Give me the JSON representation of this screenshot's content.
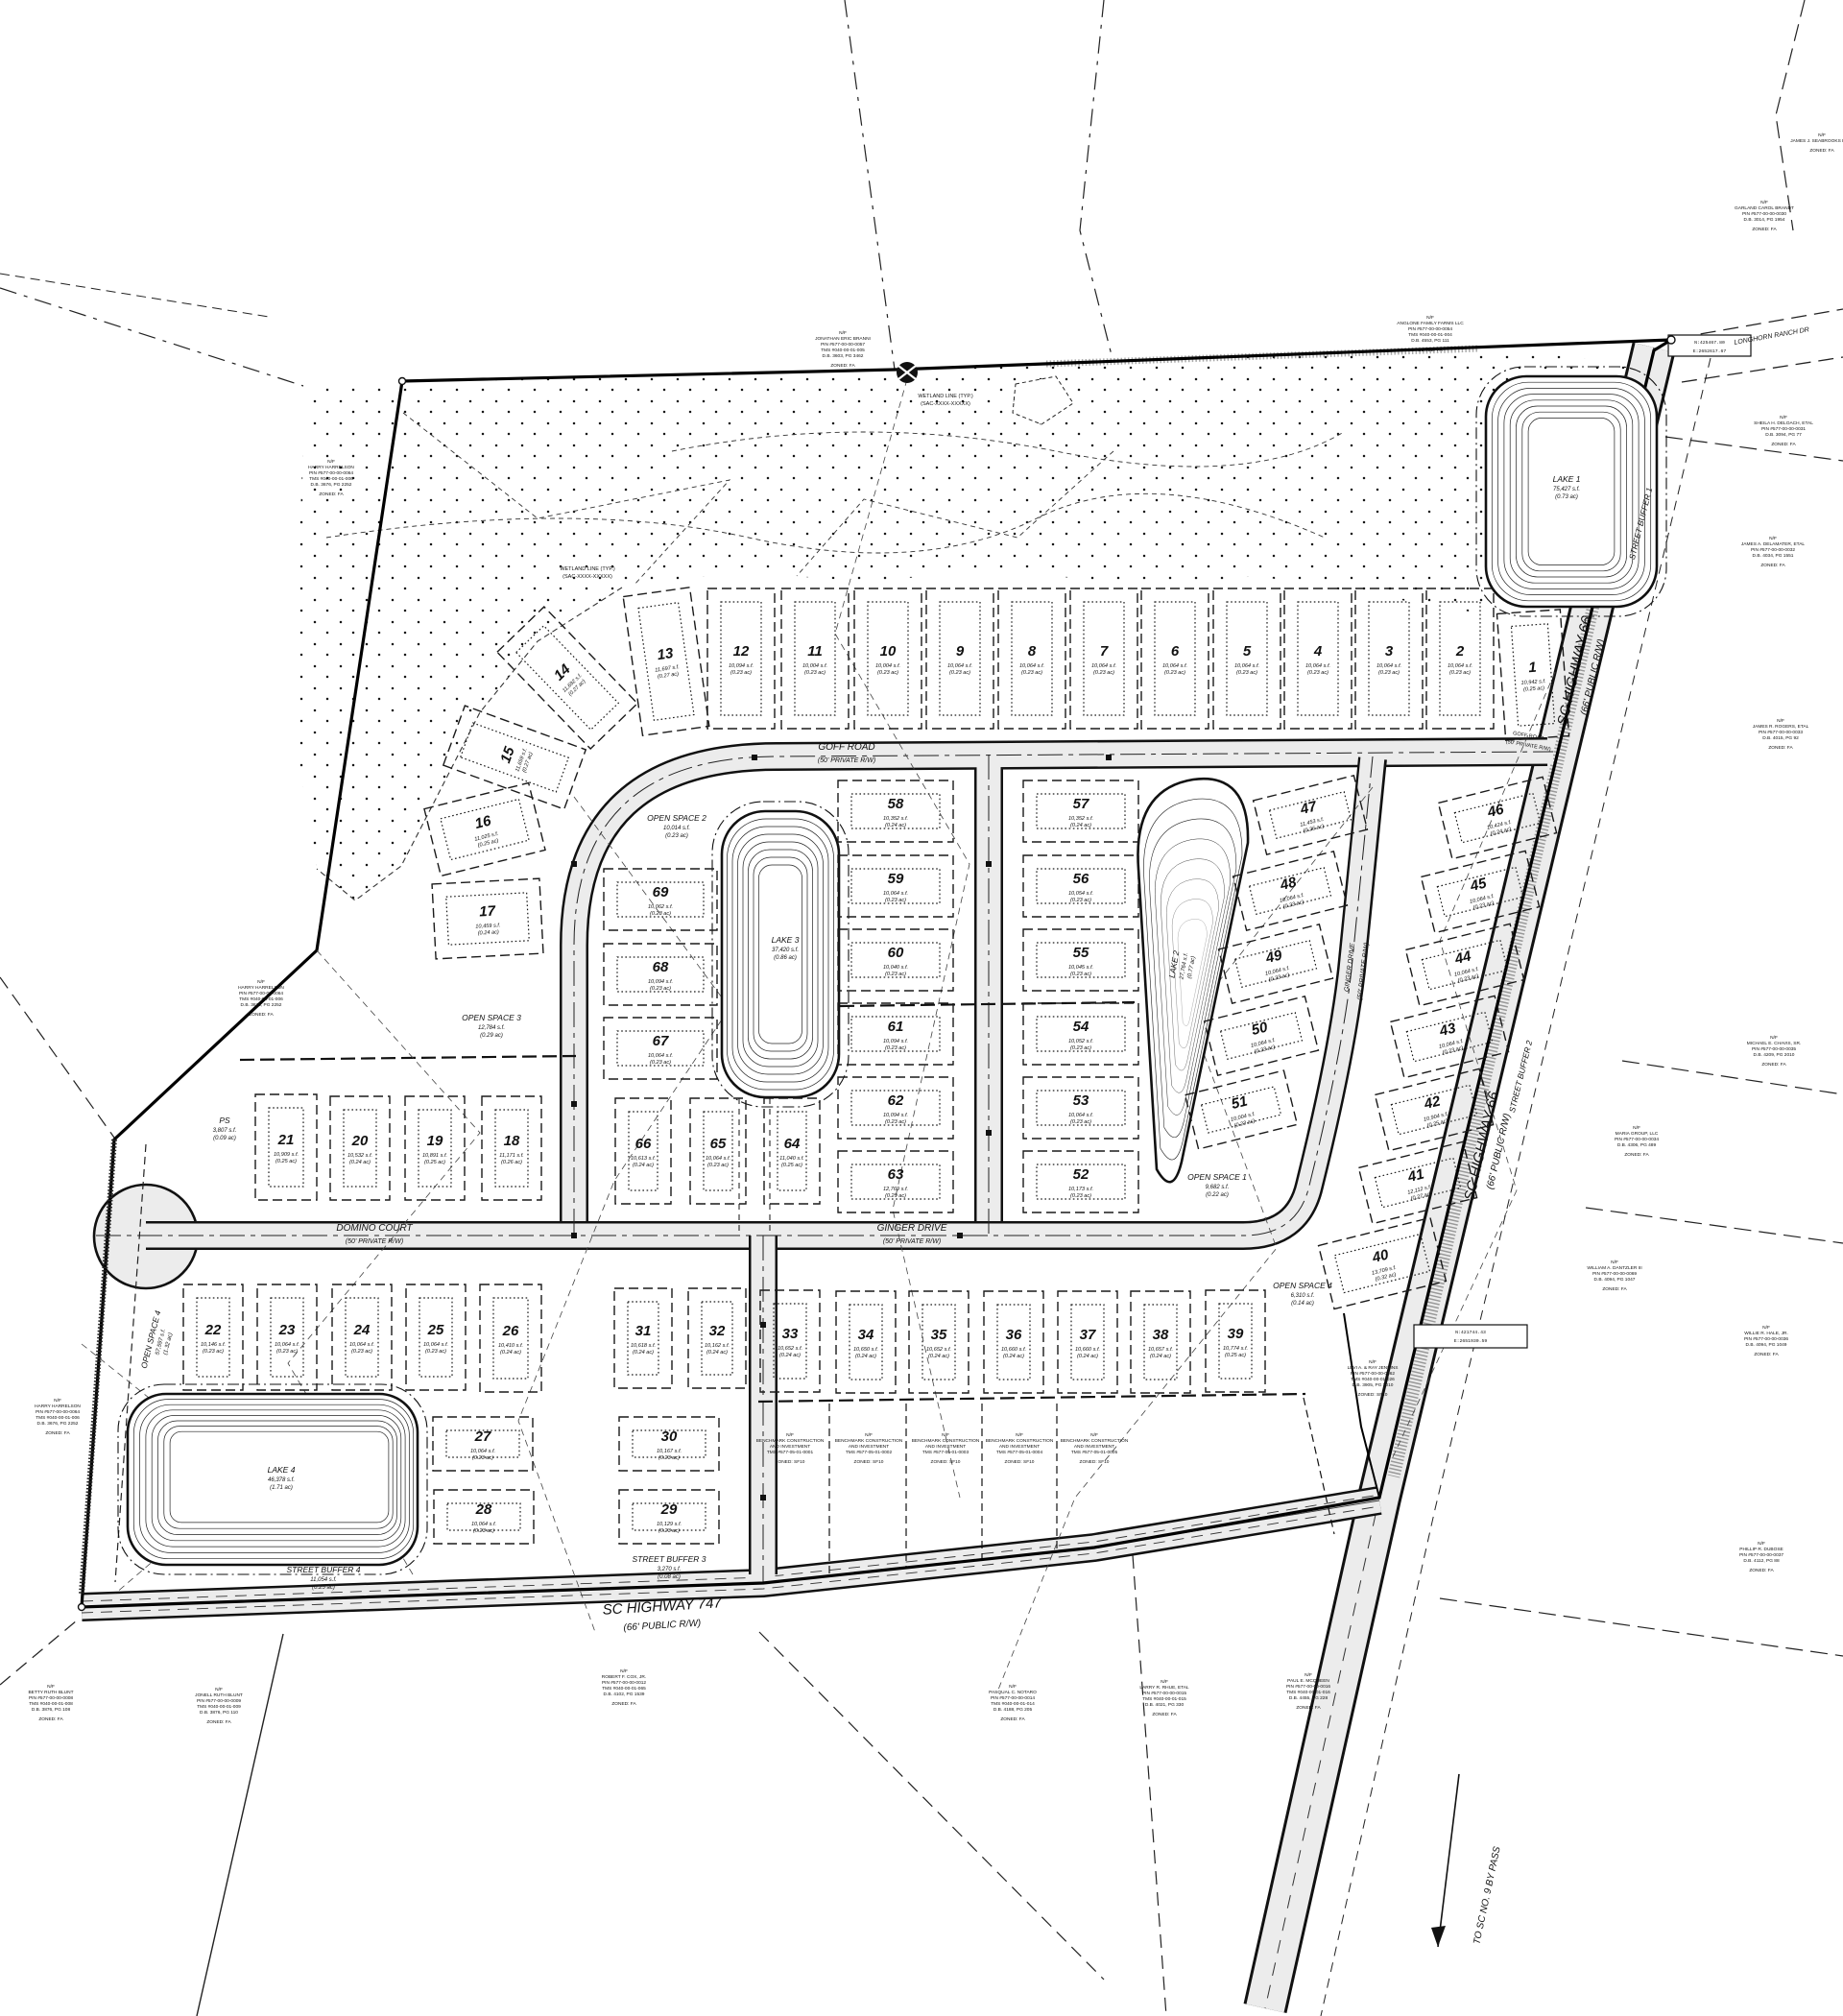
{
  "roads": {
    "goff": {
      "name": "GOFF ROAD",
      "rw": "(50' PRIVATE R/W)"
    },
    "goff_east": {
      "name": "GOFF ROAD",
      "rw": "(50' PRIVATE R/W)"
    },
    "domino": {
      "name": "DOMINO COURT",
      "rw": "(50' PRIVATE R/W)"
    },
    "ginger": {
      "name": "GINGER DRIVE",
      "rw": "(50' PRIVATE R/W)"
    },
    "ginger_diag": {
      "name": "GINGER DRIVE",
      "rw": "(50' PRIVATE R/W)"
    },
    "hwy747": {
      "name": "SC HIGHWAY 747",
      "rw": "(66' PUBLIC R/W)"
    },
    "hwy66_upper": {
      "name": "SC HIGHWAY 66",
      "rw": "(66' PUBLIC R/W)"
    },
    "hwy66_lower": {
      "name": "SC HIGHWAY 66",
      "rw": "(66' PUBLIC R/W)"
    },
    "longhorn": {
      "name": "LONGHORN RANCH DR"
    },
    "to_sc9": {
      "name": "TO SC NO. 9 BY PASS"
    }
  },
  "wetland": {
    "label": "WETLAND LINE (TYP.)",
    "sub": "(SAC-XXXX-XXXXX)"
  },
  "lakes": [
    {
      "name": "LAKE 1",
      "area": "75,427 s.f.",
      "acres": "(0.73 ac)"
    },
    {
      "name": "LAKE 2",
      "area": "27,764 s.f.",
      "acres": "(0.77 ac)"
    },
    {
      "name": "LAKE 3",
      "area": "37,420 s.f.",
      "acres": "(0.86 ac)"
    },
    {
      "name": "LAKE 4",
      "area": "46,378 s.f.",
      "acres": "(1.71 ac)"
    }
  ],
  "open_spaces": [
    {
      "name": "OPEN SPACE 1",
      "area": "9,682 s.f.",
      "acres": "(0.22 ac)"
    },
    {
      "name": "OPEN SPACE 2",
      "area": "10,014 s.f.",
      "acres": "(0.23 ac)"
    },
    {
      "name": "OPEN SPACE 3",
      "area": "12,784 s.f.",
      "acres": "(0.29 ac)"
    },
    {
      "name": "OPEN SPACE 4",
      "area": "6,310 s.f.",
      "acres": "(0.14 ac)"
    },
    {
      "name": "OPEN SPACE 4",
      "area": "57,597 s.f.",
      "acres": "(1.32 ac)"
    }
  ],
  "street_buffers": [
    {
      "name": "STREET BUFFER 1",
      "area": "",
      "acres": ""
    },
    {
      "name": "STREET BUFFER 2",
      "area": "",
      "acres": ""
    },
    {
      "name": "STREET BUFFER 3",
      "area": "3,270 s.f.",
      "acres": "(0.08 ac)"
    },
    {
      "name": "STREET BUFFER 4",
      "area": "11,054 s.f.",
      "acres": "(0.25 ac)"
    }
  ],
  "pump_station": {
    "name": "PS",
    "area": "3,807 s.f.",
    "acres": "(0.09 ac)"
  },
  "coord_boxes": [
    {
      "lines": [
        "N:421744.43",
        "E:2651930.59"
      ]
    },
    {
      "lines": [
        "N:425467.80",
        "E:2652617.67"
      ]
    }
  ],
  "lots": [
    {
      "num": "1",
      "area": "10,942 s.f.",
      "acres": "(0.25 ac)"
    },
    {
      "num": "2",
      "area": "10,064 s.f.",
      "acres": "(0.23 ac)"
    },
    {
      "num": "3",
      "area": "10,064 s.f.",
      "acres": "(0.23 ac)"
    },
    {
      "num": "4",
      "area": "10,064 s.f.",
      "acres": "(0.23 ac)"
    },
    {
      "num": "5",
      "area": "10,064 s.f.",
      "acres": "(0.23 ac)"
    },
    {
      "num": "6",
      "area": "10,064 s.f.",
      "acres": "(0.23 ac)"
    },
    {
      "num": "7",
      "area": "10,064 s.f.",
      "acres": "(0.23 ac)"
    },
    {
      "num": "8",
      "area": "10,064 s.f.",
      "acres": "(0.23 ac)"
    },
    {
      "num": "9",
      "area": "10,064 s.f.",
      "acres": "(0.23 ac)"
    },
    {
      "num": "10",
      "area": "10,004 s.f.",
      "acres": "(0.23 ac)"
    },
    {
      "num": "11",
      "area": "10,004 s.f.",
      "acres": "(0.23 ac)"
    },
    {
      "num": "12",
      "area": "10,094 s.f.",
      "acres": "(0.23 ac)"
    },
    {
      "num": "13",
      "area": "11,697 s.f.",
      "acres": "(0.27 ac)"
    },
    {
      "num": "14",
      "area": "11,692 s.f.",
      "acres": "(0.27 ac)"
    },
    {
      "num": "15",
      "area": "11,659 s.f.",
      "acres": "(0.27 ac)"
    },
    {
      "num": "16",
      "area": "11,025 s.f.",
      "acres": "(0.25 ac)"
    },
    {
      "num": "17",
      "area": "10,459 s.f.",
      "acres": "(0.24 ac)"
    },
    {
      "num": "18",
      "area": "11,171 s.f.",
      "acres": "(0.26 ac)"
    },
    {
      "num": "19",
      "area": "10,891 s.f.",
      "acres": "(0.25 ac)"
    },
    {
      "num": "20",
      "area": "10,532 s.f.",
      "acres": "(0.24 ac)"
    },
    {
      "num": "21",
      "area": "10,909 s.f.",
      "acres": "(0.25 ac)"
    },
    {
      "num": "22",
      "area": "10,146 s.f.",
      "acres": "(0.23 ac)"
    },
    {
      "num": "23",
      "area": "10,064 s.f.",
      "acres": "(0.23 ac)"
    },
    {
      "num": "24",
      "area": "10,064 s.f.",
      "acres": "(0.23 ac)"
    },
    {
      "num": "25",
      "area": "10,064 s.f.",
      "acres": "(0.23 ac)"
    },
    {
      "num": "26",
      "area": "10,410 s.f.",
      "acres": "(0.24 ac)"
    },
    {
      "num": "27",
      "area": "10,064 s.f.",
      "acres": "(0.23 ac)"
    },
    {
      "num": "28",
      "area": "10,064 s.f.",
      "acres": "(0.23 ac)"
    },
    {
      "num": "29",
      "area": "10,129 s.f.",
      "acres": "(0.23 ac)"
    },
    {
      "num": "30",
      "area": "10,167 s.f.",
      "acres": "(0.23 ac)"
    },
    {
      "num": "31",
      "area": "10,618 s.f.",
      "acres": "(0.24 ac)"
    },
    {
      "num": "32",
      "area": "10,162 s.f.",
      "acres": "(0.24 ac)"
    },
    {
      "num": "33",
      "area": "10,652 s.f.",
      "acres": "(0.24 ac)"
    },
    {
      "num": "34",
      "area": "10,650 s.f.",
      "acres": "(0.24 ac)"
    },
    {
      "num": "35",
      "area": "10,652 s.f.",
      "acres": "(0.24 ac)"
    },
    {
      "num": "36",
      "area": "10,660 s.f.",
      "acres": "(0.24 ac)"
    },
    {
      "num": "37",
      "area": "10,660 s.f.",
      "acres": "(0.24 ac)"
    },
    {
      "num": "38",
      "area": "10,657 s.f.",
      "acres": "(0.24 ac)"
    },
    {
      "num": "39",
      "area": "10,774 s.f.",
      "acres": "(0.25 ac)"
    },
    {
      "num": "40",
      "area": "13,709 s.f.",
      "acres": "(0.32 ac)"
    },
    {
      "num": "41",
      "area": "12,112 s.f.",
      "acres": "(0.27 ac)"
    },
    {
      "num": "42",
      "area": "10,904 s.f.",
      "acres": "(0.25 ac)"
    },
    {
      "num": "43",
      "area": "10,064 s.f.",
      "acres": "(0.23 ac)"
    },
    {
      "num": "44",
      "area": "10,064 s.f.",
      "acres": "(0.23 ac)"
    },
    {
      "num": "45",
      "area": "10,064 s.f.",
      "acres": "(0.23 ac)"
    },
    {
      "num": "46",
      "area": "10,424 s.f.",
      "acres": "(0.24 ac)"
    },
    {
      "num": "47",
      "area": "11,453 s.f.",
      "acres": "(0.26 ac)"
    },
    {
      "num": "48",
      "area": "10,064 s.f.",
      "acres": "(0.23 ac)"
    },
    {
      "num": "49",
      "area": "10,064 s.f.",
      "acres": "(0.23 ac)"
    },
    {
      "num": "50",
      "area": "10,064 s.f.",
      "acres": "(0.23 ac)"
    },
    {
      "num": "51",
      "area": "10,004 s.f.",
      "acres": "(0.23 ac)"
    },
    {
      "num": "52",
      "area": "10,173 s.f.",
      "acres": "(0.23 ac)"
    },
    {
      "num": "53",
      "area": "10,064 s.f.",
      "acres": "(0.23 ac)"
    },
    {
      "num": "54",
      "area": "10,052 s.f.",
      "acres": "(0.23 ac)"
    },
    {
      "num": "55",
      "area": "10,045 s.f.",
      "acres": "(0.23 ac)"
    },
    {
      "num": "56",
      "area": "10,054 s.f.",
      "acres": "(0.23 ac)"
    },
    {
      "num": "57",
      "area": "10,352 s.f.",
      "acres": "(0.24 ac)"
    },
    {
      "num": "58",
      "area": "10,352 s.f.",
      "acres": "(0.24 ac)"
    },
    {
      "num": "59",
      "area": "10,064 s.f.",
      "acres": "(0.23 ac)"
    },
    {
      "num": "60",
      "area": "10,040 s.f.",
      "acres": "(0.23 ac)"
    },
    {
      "num": "61",
      "area": "10,094 s.f.",
      "acres": "(0.23 ac)"
    },
    {
      "num": "62",
      "area": "10,094 s.f.",
      "acres": "(0.23 ac)"
    },
    {
      "num": "63",
      "area": "12,769 s.f.",
      "acres": "(0.29 ac)"
    },
    {
      "num": "64",
      "area": "11,040 s.f.",
      "acres": "(0.25 ac)"
    },
    {
      "num": "65",
      "area": "10,064 s.f.",
      "acres": "(0.23 ac)"
    },
    {
      "num": "66",
      "area": "10,613 s.f.",
      "acres": "(0.24 ac)"
    },
    {
      "num": "67",
      "area": "10,064 s.f.",
      "acres": "(0.23 ac)"
    },
    {
      "num": "68",
      "area": "10,094 s.f.",
      "acres": "(0.23 ac)"
    },
    {
      "num": "69",
      "area": "10,062 s.f.",
      "acres": "(0.23 ac)"
    }
  ],
  "owners": [
    {
      "lines": [
        "N/F",
        "JONATHAN ERIC BRANNI",
        "PIN #577-00-00-0057",
        "TMS #040-00-01-005",
        "D.B. 3603, PG 3462",
        "ZONED: FA"
      ]
    },
    {
      "lines": [
        "N/F",
        "ANGLONE FAMILY FARMS LLC",
        "PIN #577-00-00-0054",
        "TMS #040-00-01-004",
        "D.B. 4553, PG 111",
        "ZONED: FA"
      ]
    },
    {
      "lines": [
        "N/F",
        "HARRY HARRELSON",
        "PIN #577-00-00-0064",
        "TMS #040-00-01-006",
        "D.B. 3676, PG 2252",
        "ZONED: FA"
      ]
    },
    {
      "lines": [
        "N/F",
        "HARRY HARRELSON",
        "PIN #577-00-00-0064",
        "TMS #040-00-01-006",
        "D.B. 3676, PG 2252",
        "ZONED: FA"
      ]
    },
    {
      "lines": [
        "N/F",
        "HARRY HARRELSON",
        "PIN #577-00-00-0064",
        "TMS #040-00-01-006",
        "D.B. 3676, PG 2252",
        "ZONED: FA"
      ]
    },
    {
      "lines": [
        "N/F",
        "BETTY RUTH BLUNT",
        "PIN #577-00-00-0008",
        "TMS #040-00-01-008",
        "D.B. 3876, PG 108",
        "ZONED: FA"
      ]
    },
    {
      "lines": [
        "N/F",
        "JONELL RUTH BLUNT",
        "PIN #577-00-00-0009",
        "TMS #040-00-01-009",
        "D.B. 3876, PG 110",
        "ZONED: FA"
      ]
    },
    {
      "lines": [
        "N/F",
        "ROBERT F. COX, JR.",
        "PIN #577-00-00-0012",
        "TMS #040-00-01-065",
        "D.B. 4102, PG 1539",
        "ZONED: FA"
      ]
    },
    {
      "lines": [
        "N/F",
        "PASQUAL C. NOTARO",
        "PIN #577-00-00-0014",
        "TMS #040-00-01-014",
        "D.B. 4188, PG 205",
        "ZONED: FA"
      ]
    },
    {
      "lines": [
        "N/F",
        "LARRY R. RHUE, ETAL",
        "PIN #577-00-00-0015",
        "TMS #040-00-01-015",
        "D.B. 4021, PG 330",
        "ZONED: FA"
      ]
    },
    {
      "lines": [
        "N/F",
        "PAUL E. MCQUEEN",
        "PIN #577-00-00-0016",
        "TMS #040-00-01-016",
        "D.B. 4455, PG 228",
        "ZONED: FA"
      ]
    },
    {
      "lines": [
        "N/F",
        "MARIA GROUP, LLC",
        "PIN #577-00-00-0034",
        "D.B. 4306, PG 489",
        "ZONED: FA"
      ]
    },
    {
      "lines": [
        "N/F",
        "WILLIAM A. DANTZLER III",
        "PIN #577-00-00-0069",
        "D.B. 4094, PG 1047",
        "ZONED: FA"
      ]
    },
    {
      "lines": [
        "N/F",
        "SHEILA H. DELOACH, ETAL",
        "PIN #577-00-00-0031",
        "D.B. 3094, PG 77",
        "ZONED: FA"
      ]
    },
    {
      "lines": [
        "N/F",
        "JAMES A. DELAMATER, ETAL",
        "PIN #577-00-00-0032",
        "D.B. 4034, PG 1551",
        "ZONED: FA"
      ]
    },
    {
      "lines": [
        "N/F",
        "JAMES R. ROGERS, ETAL",
        "PIN #577-00-00-0033",
        "D.B. 4015, PG 92",
        "ZONED: FA"
      ]
    },
    {
      "lines": [
        "N/F",
        "MICHAEL E. CHAVIS, SR.",
        "PIN #577-00-00-0035",
        "D.B. 4209, PG 2010",
        "ZONED: FA"
      ]
    },
    {
      "lines": [
        "N/F",
        "WILLIE R. HALE, JR.",
        "PIN #577-00-00-0036",
        "D.B. 4094, PG 1049",
        "ZONED: FA"
      ]
    },
    {
      "lines": [
        "N/F",
        "PHILLIP R. DUBOSE",
        "PIN #577-00-00-0037",
        "D.B. 4112, PG 88",
        "ZONED: FA"
      ]
    },
    {
      "lines": [
        "N/F",
        "GARLAND CAROL BRANDT",
        "PIN #577-00-00-0030",
        "D.B. 3014, PG 1954",
        "ZONED: FA"
      ]
    },
    {
      "lines": [
        "N/F",
        "JAMES J. SEABROOKS ETAL",
        "ZONED: FA"
      ]
    },
    {
      "lines": [
        "N/F",
        "BENCHMARK CONSTRUCTION",
        "AND INVESTMENT",
        "TMS #577-05-01-0001",
        "ZONED: SF10"
      ]
    },
    {
      "lines": [
        "N/F",
        "BENCHMARK CONSTRUCTION",
        "AND INVESTMENT",
        "TMS #577-05-01-0002",
        "ZONED: SF10"
      ]
    },
    {
      "lines": [
        "N/F",
        "BENCHMARK CONSTRUCTION",
        "AND INVESTMENT",
        "TMS #577-05-01-0003",
        "ZONED: SF10"
      ]
    },
    {
      "lines": [
        "N/F",
        "BENCHMARK CONSTRUCTION",
        "AND INVESTMENT",
        "TMS #577-05-01-0004",
        "ZONED: SF10"
      ]
    },
    {
      "lines": [
        "N/F",
        "BENCHMARK CONSTRUCTION",
        "AND INVESTMENT",
        "TMS #577-05-01-0005",
        "ZONED: SF10"
      ]
    },
    {
      "lines": [
        "N/F",
        "LEVI A. & RAY JENKINS",
        "PIN #577-00-00-0062",
        "TMS #040-00-01-026",
        "D.B. 3905, PG 2010",
        "ZONED: SF10"
      ]
    }
  ]
}
